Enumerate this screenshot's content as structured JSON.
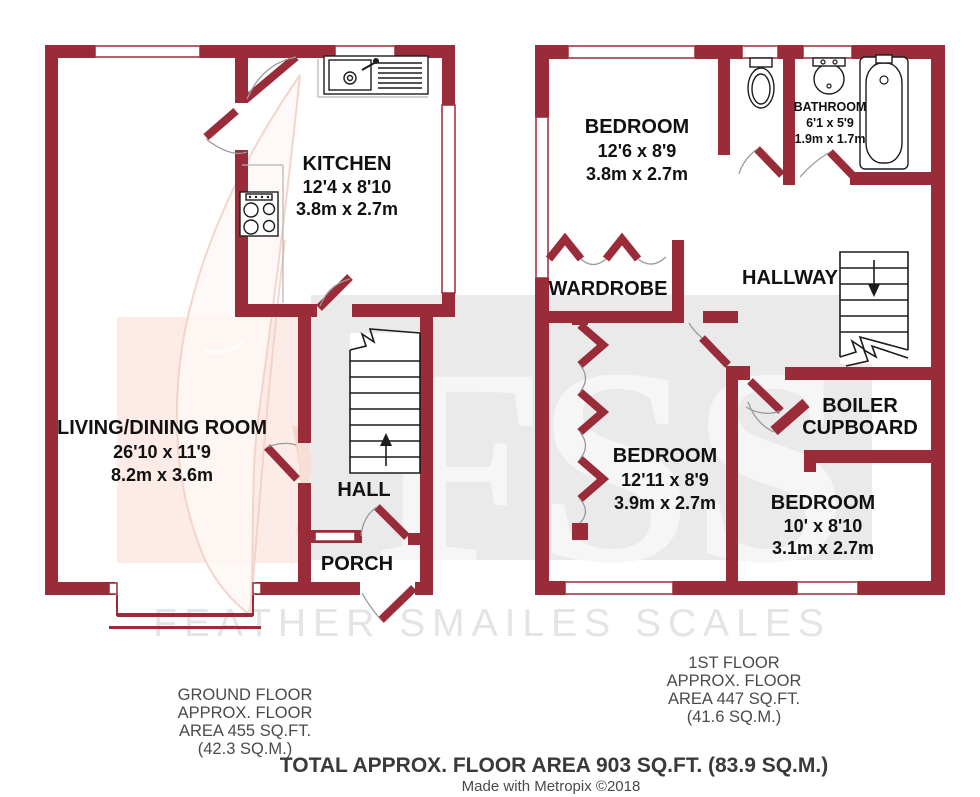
{
  "watermark": {
    "initials_f": "F",
    "initials_s1": "S",
    "initials_s2": "S",
    "name": "FEATHER SMAILES SCALES"
  },
  "ground_floor": {
    "rooms": {
      "kitchen": {
        "name": "KITCHEN",
        "size_imperial": "12'4 x 8'10",
        "size_metric": "3.8m x 2.7m"
      },
      "living_dining_room": {
        "name": "LIVING/DINING ROOM",
        "size_imperial": "26'10 x 11'9",
        "size_metric": "8.2m x 3.6m"
      },
      "hall": {
        "name": "HALL"
      },
      "porch": {
        "name": "PORCH"
      }
    },
    "caption": [
      "GROUND FLOOR",
      "APPROX. FLOOR",
      "AREA 455 SQ.FT.",
      "(42.3 SQ.M.)"
    ]
  },
  "first_floor": {
    "rooms": {
      "bedroom_front": {
        "name": "BEDROOM",
        "size_imperial": "12'6 x 8'9",
        "size_metric": "3.8m x 2.7m"
      },
      "bathroom": {
        "name": "BATHROOM",
        "size_imperial": "6'1 x 5'9",
        "size_metric": "1.9m x 1.7m"
      },
      "wardrobe": {
        "name": "WARDROBE"
      },
      "hallway": {
        "name": "HALLWAY"
      },
      "boiler_cupboard": {
        "name_line1": "BOILER",
        "name_line2": "CUPBOARD"
      },
      "bedroom_middle": {
        "name": "BEDROOM",
        "size_imperial": "12'11 x 8'9",
        "size_metric": "3.9m x 2.7m"
      },
      "bedroom_back": {
        "name": "BEDROOM",
        "size_imperial": "10' x 8'10",
        "size_metric": "3.1m x 2.7m"
      }
    },
    "caption": [
      "1ST FLOOR",
      "APPROX. FLOOR",
      "AREA 447 SQ.FT.",
      "(41.6 SQ.M.)"
    ]
  },
  "footer": {
    "total": "TOTAL APPROX. FLOOR AREA 903 SQ.FT. (83.9 SQ.M.)",
    "credit": "Made with Metropix ©2018"
  },
  "colors": {
    "wall": "#9a2b38",
    "watermark_square": "#eaeaea",
    "watermark_pink": "#fcebe6",
    "label": "#111111",
    "caption": "#4a4a4a"
  }
}
